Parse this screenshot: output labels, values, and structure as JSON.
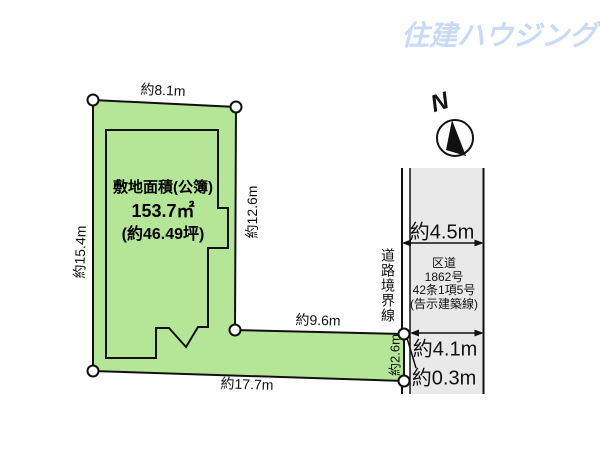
{
  "logo": {
    "text": "住建ハウジング",
    "color": "#c9daf6"
  },
  "compass": {
    "label": "N"
  },
  "parcel": {
    "fill_color": "#b5e698",
    "area_line1": "敷地面積(公簿)",
    "area_line2": "153.7㎡",
    "area_line3": "(約46.49坪)",
    "dims": {
      "top": "約8.1m",
      "left": "約15.4m",
      "right": "約12.6m",
      "strip_top": "約9.6m",
      "bottom": "約17.7m",
      "strip_right": "約2.6m"
    }
  },
  "road": {
    "fill_color": "#e9e9e9",
    "boundary_label": "道路境界線",
    "width_top": "約4.5m",
    "width_bottom": "約4.1m",
    "offset": "約0.3m",
    "name_lines": [
      "区道",
      "1862号",
      "42条1項5号",
      "(告示建築線)"
    ]
  }
}
